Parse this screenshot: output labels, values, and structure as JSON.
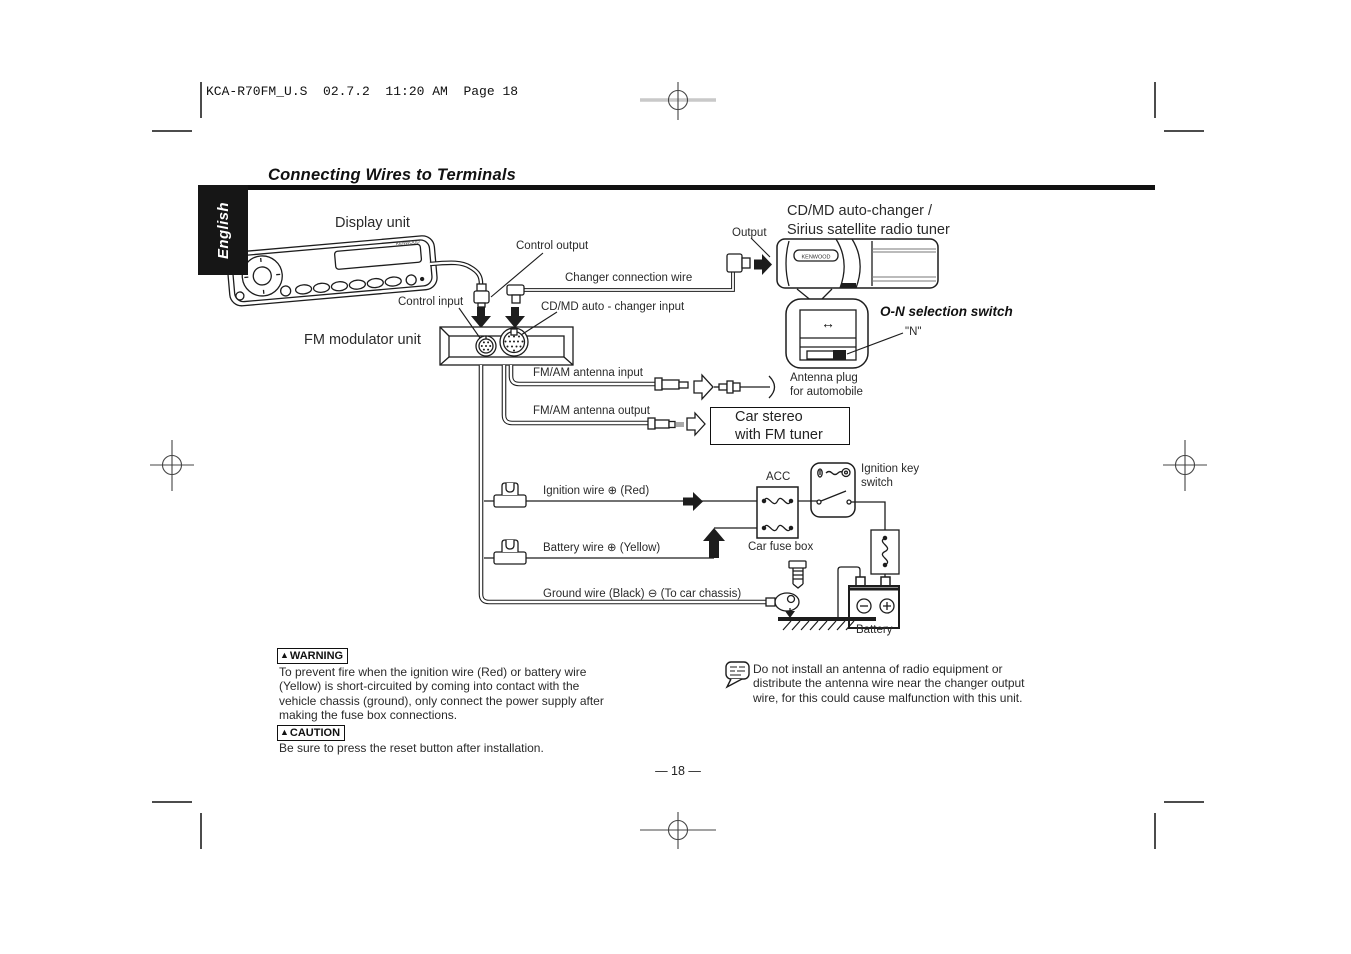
{
  "colors": {
    "ink": "#1d1d1d",
    "paper": "#ffffff"
  },
  "page": {
    "header": "KCA-R70FM_U.S  02.7.2  11:20 AM  Page 18",
    "title": "Connecting Wires to Terminals",
    "language_tab": "English",
    "page_number": "— 18 —"
  },
  "brand": "KENWOOD",
  "icons": {
    "warning_triangle": "▲",
    "switch_arrows": "↔"
  },
  "diagram": {
    "display_unit": "Display unit",
    "control_output": "Control output",
    "changer_connection_wire": "Changer connection wire",
    "control_input": "Control input",
    "cd_md_changer_input": "CD/MD auto - changer input",
    "fm_modulator_unit": "FM modulator unit",
    "fm_am_antenna_input": "FM/AM antenna input",
    "fm_am_antenna_output": "FM/AM antenna output",
    "antenna_plug": "Antenna plug\nfor automobile",
    "car_stereo_box": "Car stereo\nwith FM tuner",
    "auto_changer": "CD/MD auto-changer /\nSirius satellite radio tuner",
    "output": "Output",
    "on_selection_switch": "O-N selection switch",
    "n_position": "\"N\"",
    "acc": "ACC",
    "ignition_key_switch": "Ignition key\nswitch",
    "ignition_wire": "Ignition wire ⊕ (Red)",
    "battery_wire": "Battery wire ⊕ (Yellow)",
    "ground_wire": "Ground wire (Black) ⊖ (To car chassis)",
    "car_fuse_box": "Car fuse box",
    "battery": "Battery"
  },
  "warning": {
    "label": "WARNING",
    "text": "To prevent fire when the ignition wire (Red) or battery wire\n(Yellow) is short-circuited by coming into contact with the\nvehicle chassis (ground), only connect the power supply after\nmaking the fuse box connections."
  },
  "caution": {
    "label": "CAUTION",
    "text": "Be sure to press the reset button after installation."
  },
  "note": {
    "text": "Do not install an antenna of radio equipment or\ndistribute the antenna wire near the changer output\nwire, for this could cause malfunction with this unit."
  }
}
